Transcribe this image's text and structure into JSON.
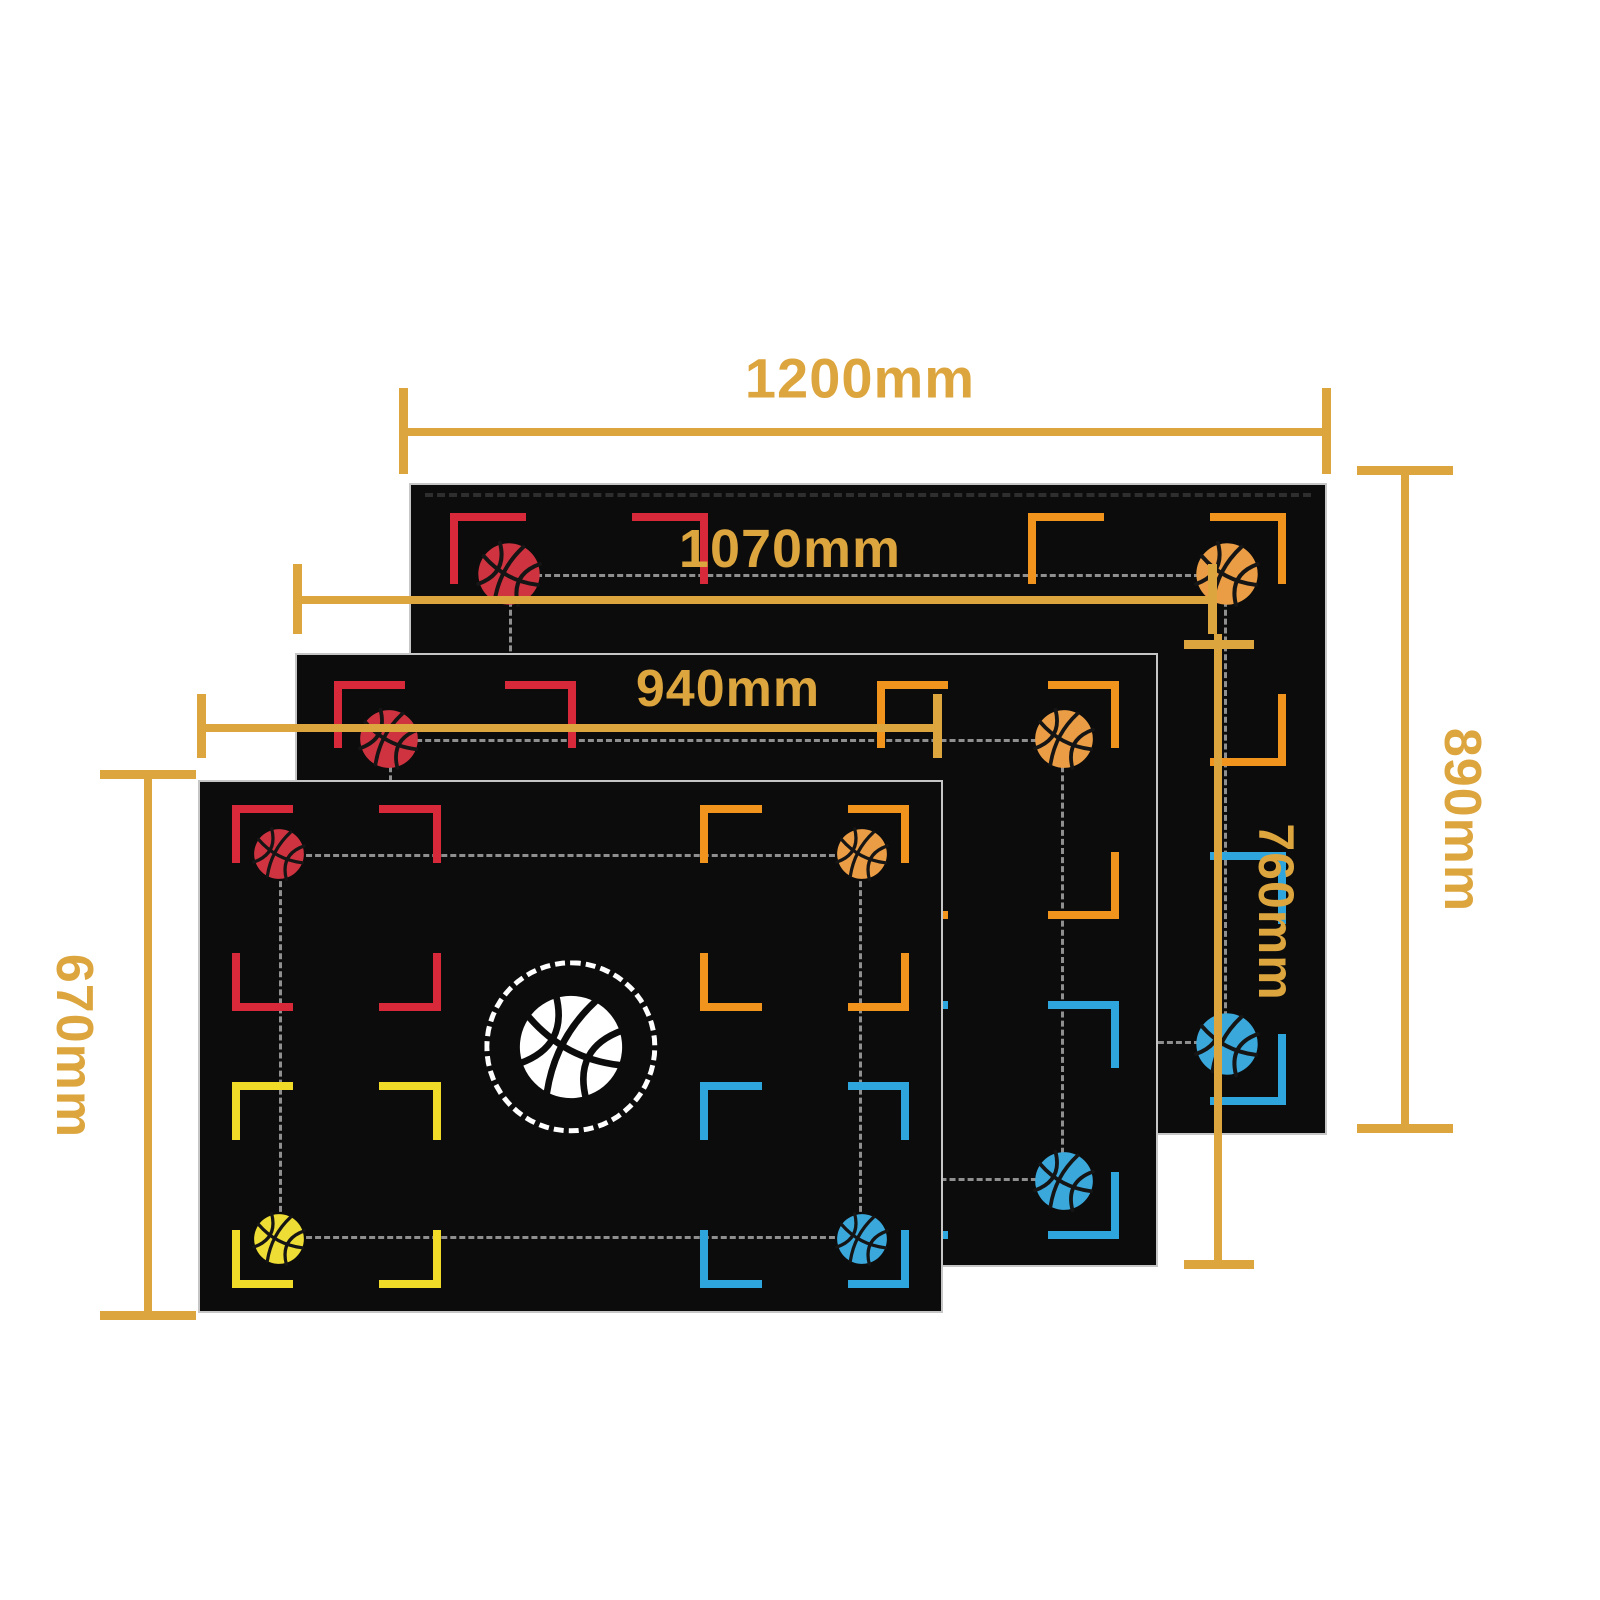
{
  "diagram": {
    "type": "product-size-diagram",
    "subject": "basketball training mat sizes",
    "background": "#ffffff",
    "accent_gold": "#dda53e",
    "mat_color": "#0c0c0c",
    "mat_border_color": "#c6c6c6",
    "connector_dash_color": "#8f8f8f",
    "center_icon": "basketball",
    "marker_colors": {
      "red": "#d8293a",
      "orange": "#f1941d",
      "yellow": "#f0dc28",
      "blue": "#2ea5dc"
    },
    "ball_colors": {
      "red": "#cf3340",
      "orange": "#eb9d45",
      "yellow": "#eedd35",
      "blue": "#3ba8dc",
      "white": "#ffffff"
    },
    "mats": [
      {
        "id": "largest",
        "width_label": "1200mm",
        "height_label": "890mm"
      },
      {
        "id": "medium",
        "width_label": "1070mm",
        "height_label": "760mm"
      },
      {
        "id": "smallest",
        "width_label": "940mm",
        "height_label": "670mm"
      }
    ]
  }
}
